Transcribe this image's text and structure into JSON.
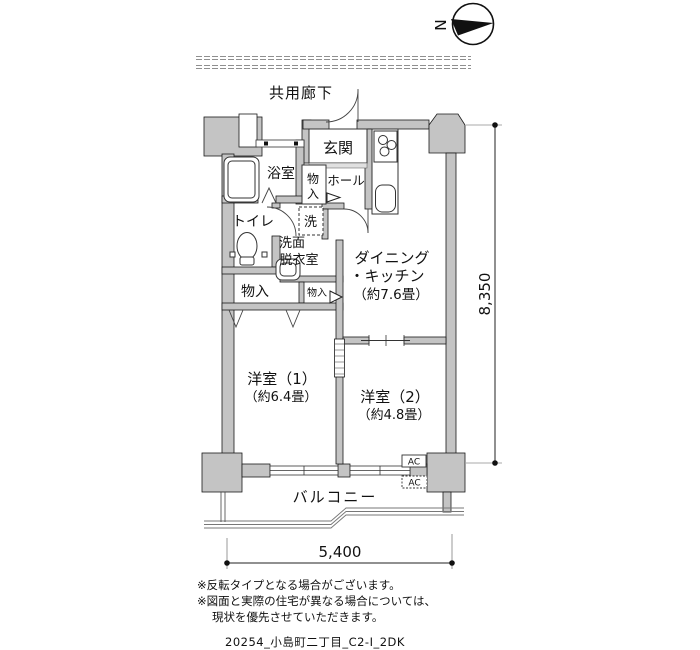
{
  "compass": {
    "north": "N"
  },
  "corridor": {
    "label": "共用廊下"
  },
  "rooms": {
    "entrance": {
      "label": "玄関"
    },
    "bath": {
      "label": "浴室"
    },
    "toilet": {
      "label": "トイレ"
    },
    "hall": {
      "label": "ホール"
    },
    "hall_storage": {
      "char1": "物",
      "char2": "入"
    },
    "washer": {
      "label": "洗"
    },
    "washroom": {
      "line1": "洗面",
      "line2": "脱衣室"
    },
    "closet_large": {
      "label": "物入"
    },
    "closet_small": {
      "label": "物入"
    },
    "dining_kitchen": {
      "line1": "ダイニング",
      "line2": "・キッチン",
      "line3": "（約7.6畳）"
    },
    "bedroom1": {
      "line1": "洋室（1）",
      "line2": "（約6.4畳）"
    },
    "bedroom2": {
      "line1": "洋室（2）",
      "line2": "（約4.8畳）"
    },
    "balcony": {
      "label": "バルコニー"
    }
  },
  "equipment": {
    "ac_indoor": "AC",
    "ac_outdoor": "AC"
  },
  "dimensions": {
    "vertical": "8,350",
    "horizontal": "5,400"
  },
  "notes": {
    "line1": "※反転タイプとなる場合がございます。",
    "line2": "※図面と実際の住宅が異なる場合については、",
    "line3": "現状を優先させていただきます。"
  },
  "plan_id": "20254_小島町二丁目_C2-I_2DK",
  "colors": {
    "wall_fill": "#c4c4c4",
    "outline": "#1a1a1a",
    "background": "#ffffff"
  }
}
